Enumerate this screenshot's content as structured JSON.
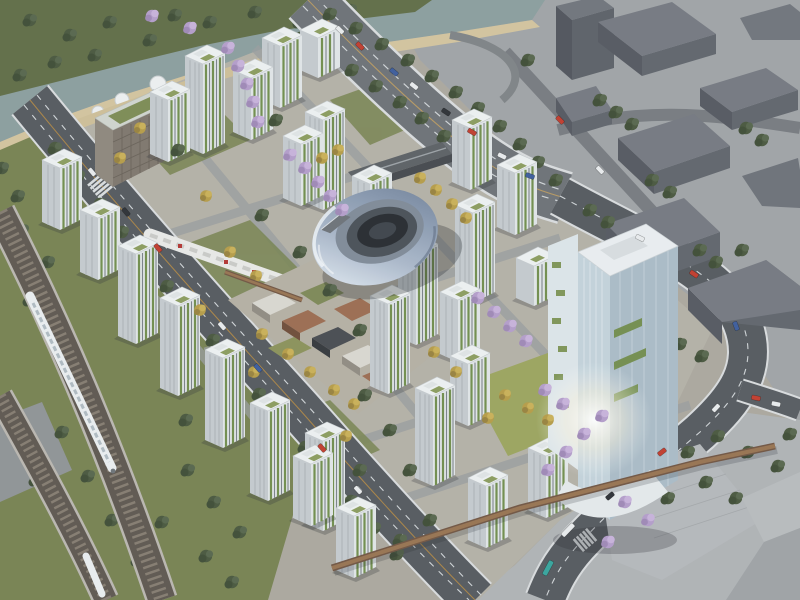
{
  "scene": {
    "title": "aerial-masterplan-rendering",
    "description": "Daytime bird's-eye architectural rendering of an eco mixed-use district: white residential towers with green vertical gardens, a central iridescent torus-shaped civic building, a tall glass office tower, surrounded by highways, a rail viaduct with a high-speed train, a river park, jacaranda trees and gray context-city massing blocks.",
    "landmarks": [
      "river-and-park-island",
      "beach-promenade",
      "elevated-highway",
      "context-city-blocks",
      "rail-viaduct-with-train",
      "tree-lined-boulevard",
      "residential-towers-with-vertical-gardens",
      "central-torus-building",
      "glass-office-tower",
      "retail-podium-village",
      "pedestrian-bridge",
      "jacaranda-street-trees",
      "south-east-plaza"
    ],
    "palette": {
      "water": "#8a9c9c",
      "park_green": "#5e6b44",
      "grass": "#75804f",
      "sand": "#d2c29c",
      "asphalt": "#53575c",
      "highway": "#6b6f74",
      "rail_ballast": "#5c554d",
      "tower_facade": "#e0e4e6",
      "vertical_garden": "#6f8c4a",
      "torus_silver": "#9fadbf",
      "jacaranda": "#b39bc9",
      "autumn_tree": "#b59a45",
      "context_block": "#5e626a",
      "office_glass": "#c2d1da",
      "bridge_wood": "#96714f"
    },
    "vehicles": [
      "white-train",
      "cars-red-white-blue-dark",
      "teal-bus",
      "white-bus"
    ]
  }
}
